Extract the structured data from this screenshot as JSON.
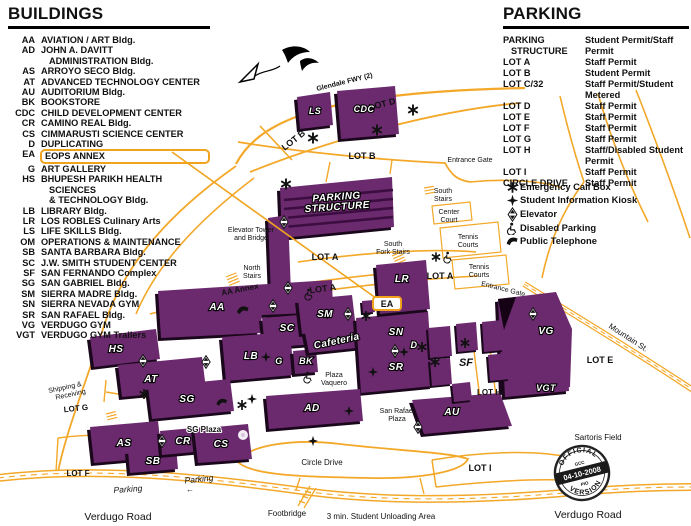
{
  "colors": {
    "building": "#6c2a6e",
    "building_shadow": "#1a071b",
    "road": "#f3a829",
    "highlight": "#f0a41e"
  },
  "buildings_legend": {
    "title": "BUILDINGS",
    "items": [
      {
        "abbr": "AA",
        "name": "AVIATION / ART Bldg."
      },
      {
        "abbr": "AD",
        "name": "JOHN A. DAVITT\nADMINISTRATION Bldg."
      },
      {
        "abbr": "AS",
        "name": "ARROYO SECO Bldg."
      },
      {
        "abbr": "AT",
        "name": "ADVANCED TECHNOLOGY CENTER"
      },
      {
        "abbr": "AU",
        "name": "AUDITORIUM Bldg."
      },
      {
        "abbr": "BK",
        "name": "BOOKSTORE"
      },
      {
        "abbr": "CDC",
        "name": "CHILD DEVELOPMENT CENTER"
      },
      {
        "abbr": "CR",
        "name": "CAMINO REAL Bldg."
      },
      {
        "abbr": "CS",
        "name": "CIMMARUSTI SCIENCE CENTER"
      },
      {
        "abbr": "D",
        "name": "DUPLICATING"
      },
      {
        "abbr": "EA",
        "name": "EOPS ANNEX",
        "highlighted": true
      },
      {
        "abbr": "G",
        "name": "ART GALLERY"
      },
      {
        "abbr": "HS",
        "name": "BHUPESH PARIKH HEALTH SCIENCES\n& TECHNOLOGY Bldg."
      },
      {
        "abbr": "LB",
        "name": "LIBRARY Bldg."
      },
      {
        "abbr": "LR",
        "name": "LOS ROBLES Culinary Arts"
      },
      {
        "abbr": "LS",
        "name": "LIFE SKILLS Bldg."
      },
      {
        "abbr": "OM",
        "name": "OPERATIONS & MAINTENANCE"
      },
      {
        "abbr": "SB",
        "name": "SANTA BARBARA Bldg."
      },
      {
        "abbr": "SC",
        "name": "J.W. SMITH STUDENT CENTER"
      },
      {
        "abbr": "SF",
        "name": "SAN FERNANDO Complex"
      },
      {
        "abbr": "SG",
        "name": "SAN GABRIEL Bldg."
      },
      {
        "abbr": "SM",
        "name": "SIERRA MADRE Bldg."
      },
      {
        "abbr": "SN",
        "name": "SIERRA NEVADA GYM"
      },
      {
        "abbr": "SR",
        "name": "SAN RAFAEL Bldg."
      },
      {
        "abbr": "VG",
        "name": "VERDUGO GYM"
      },
      {
        "abbr": "VGT",
        "name": "VERDUGO GYM Trailers"
      }
    ]
  },
  "parking_legend": {
    "title": "PARKING",
    "rows": [
      {
        "lot": "PARKING\nSTRUCTURE",
        "permit": "Student Permit/Staff Permit"
      },
      {
        "lot": "LOT A",
        "permit": "Staff Permit"
      },
      {
        "lot": "LOT B",
        "permit": "Student Permit"
      },
      {
        "lot": "LOT C/32",
        "permit": "Staff Permit/Student Metered"
      },
      {
        "lot": "LOT D",
        "permit": "Staff Permit"
      },
      {
        "lot": "LOT E",
        "permit": "Staff Permit"
      },
      {
        "lot": "LOT F",
        "permit": "Staff Permit"
      },
      {
        "lot": "LOT G",
        "permit": "Staff Permit"
      },
      {
        "lot": "LOT H",
        "permit": "Staff/Disabled Student Permit"
      },
      {
        "lot": "LOT I",
        "permit": "Staff Permit"
      },
      {
        "lot": "CIRCLE DRIVE",
        "permit": "Staff Permit"
      }
    ]
  },
  "symbols_legend": {
    "items": [
      {
        "icon": "emergency-call-box-icon",
        "label": "Emergency Call Box"
      },
      {
        "icon": "student-info-kiosk-icon",
        "label": "Student Information Kiosk"
      },
      {
        "icon": "elevator-icon",
        "label": "Elevator"
      },
      {
        "icon": "disabled-parking-icon",
        "label": "Disabled Parking"
      },
      {
        "icon": "public-telephone-icon",
        "label": "Public Telephone"
      }
    ]
  },
  "map": {
    "buildings": {
      "aa": "AA",
      "ad": "AD",
      "as": "AS",
      "at": "AT",
      "au": "AU",
      "bk": "BK",
      "cdc": "CDC",
      "cr": "CR",
      "cs": "CS",
      "d": "D",
      "ea": "EA",
      "g": "G",
      "hs": "HS",
      "lb": "LB",
      "lr": "LR",
      "ls": "LS",
      "sb": "SB",
      "sc": "SC",
      "sf": "SF",
      "sg": "SG",
      "sm": "SM",
      "sn": "SN",
      "sr": "SR",
      "vg": "VG",
      "vgt": "VGT"
    },
    "labels": {
      "glendale_fwy": "Glendale FWY (2)",
      "lot_a": "LOT A",
      "lot_b": "LOT B",
      "lot_d": "LOT D",
      "lot_e": "LOT E",
      "lot_f": "LOT F",
      "lot_g": "LOT G",
      "lot_h": "LOT H",
      "lot_i": "LOT I",
      "entrance_gate": "Entrance Gate",
      "mountain_st": "Mountain St.",
      "verdugo_road": "Verdugo Road",
      "circle_drive": "Circle Drive",
      "footbridge": "Footbridge",
      "unloading": "3 min. Student Unloading Area",
      "sartoris_field": "Sartoris Field",
      "parking_word": "Parking",
      "left_arrow": "←",
      "aa_annex": "AA Annex",
      "sg_plaza": "SG Plaza",
      "cafeteria": "Cafeteria",
      "parking_line1": "PARKING",
      "parking_line2": "STRUCTURE",
      "north": "North",
      "south": "South",
      "stairs": "Stairs",
      "fork_stairs": "Fork Stairs",
      "center": "Center",
      "court": "Court",
      "tennis": "Tennis",
      "courts": "Courts",
      "elevator_tower": "Elevator Tower",
      "and_bridge": "and Bridge",
      "shipping": "Shipping &",
      "receiving": "Receiving",
      "san_rafael": "San Rafael",
      "plaza": "Plaza",
      "vaquero": "Vaquero"
    },
    "stamp": {
      "official": "OFFICIAL",
      "version": "VERSION",
      "gcc": "GCC",
      "date": "04-10-2008",
      "pio": "PIO"
    }
  }
}
